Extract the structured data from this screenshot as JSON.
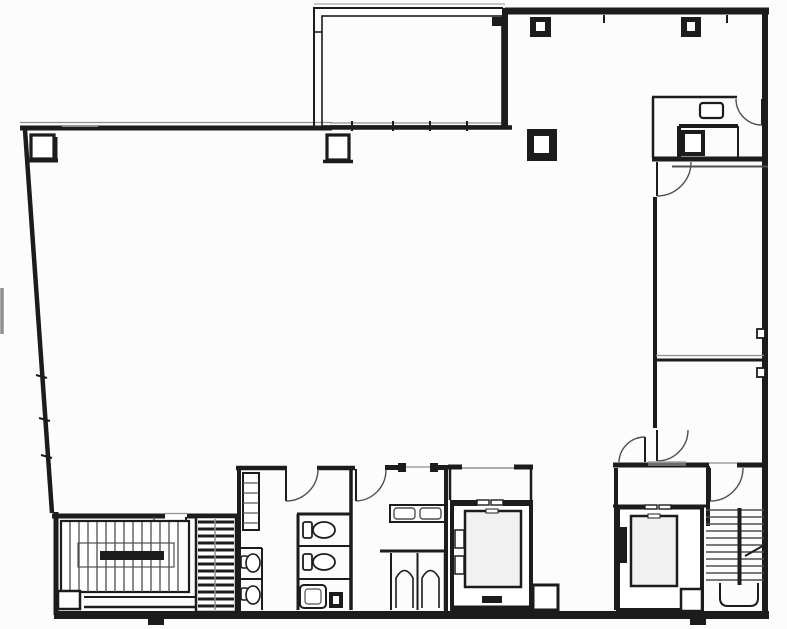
{
  "document": {
    "kind": "architectural floor plan, black line drawing on white paper",
    "background_color": "#fcfcfc",
    "ink_color": "#1c1c1c",
    "mid_line_color": "#4f4f4f",
    "light_line_color": "#909090",
    "elevator_car_fill": "#f1f1f1"
  },
  "features": {
    "open_area": "open floor area",
    "terrace": "terrace / balcony (top center)",
    "washroom_top_right": "small washroom with WC and sink",
    "room_upper_right": "upper right room",
    "room_lower_right": "lower right room",
    "lobby": "elevator lobby with swing doors",
    "stair_left": "left staircase with mid-landing",
    "stair_right": "right dog-leg staircase",
    "elevator_a": "left elevator shaft and car",
    "elevator_b": "right elevator shaft and car",
    "restrooms": "restroom block with stalls, toilets, urinals and sink counter",
    "service_shaft": "hatched service/duct shaft",
    "columns": "structural columns (square)"
  }
}
